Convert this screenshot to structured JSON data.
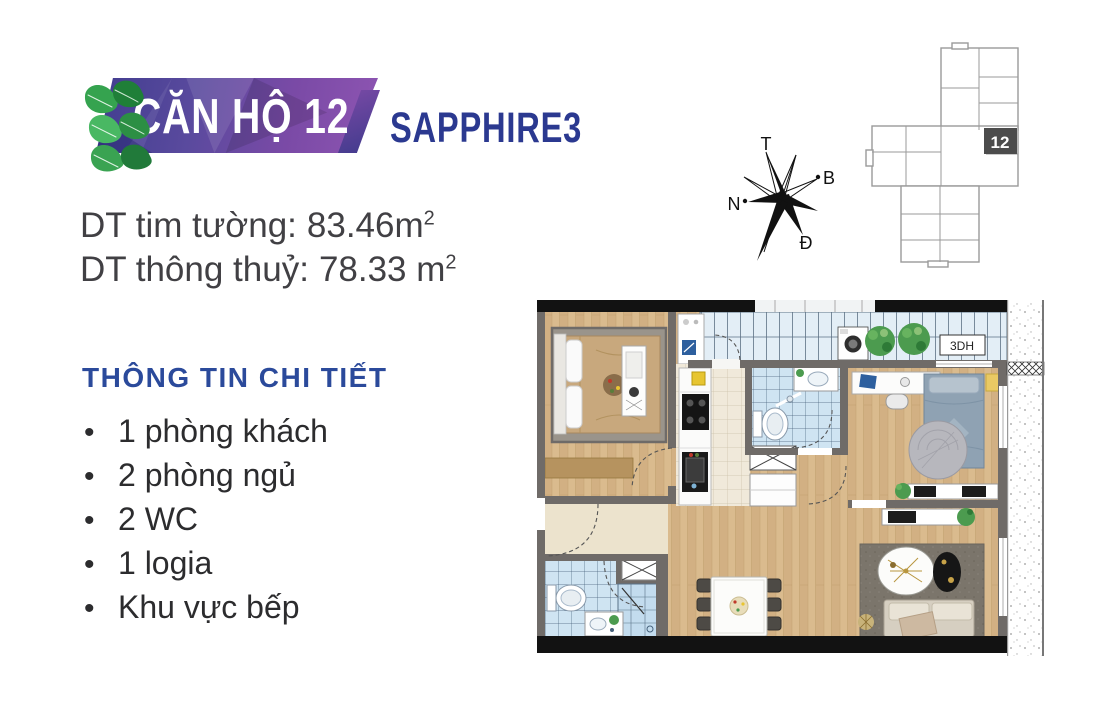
{
  "banner": {
    "unit_title": "CĂN HỘ 12",
    "project_name": "SAPPHIRE3"
  },
  "areas": {
    "line1": {
      "label": "DT tim tường:",
      "value": "83.46m",
      "sup": "2"
    },
    "line2": {
      "label": "DT thông thuỷ:",
      "value": "78.33 m",
      "sup": "2"
    }
  },
  "details": {
    "heading": "THÔNG TIN CHI TIẾT",
    "bullet": "•",
    "items": [
      "1 phòng khách",
      "2 phòng ngủ",
      "2 WC",
      "1 logia",
      "Khu vực bếp"
    ]
  },
  "compass": {
    "top": "T",
    "right": "B",
    "left": "N",
    "bottom": "Đ"
  },
  "key_plan": {
    "unit_number": "12"
  },
  "floor_plan": {
    "loggia_label": "3DH"
  },
  "colors": {
    "heading_blue": "#2b4a9b",
    "brand_navy": "#2b3990",
    "banner_purple_dark": "#413d8f",
    "banner_purple_light": "#8e55b2",
    "leaf_green": "#35a34f",
    "text_dark": "#414044",
    "wall_gray": "#6f6b68",
    "wood_floor": "#d9ba8c",
    "tile_blue": "#cfe4f2",
    "kitchen_tile": "#f0e9da",
    "unit_highlight": "#4c4c4c"
  }
}
